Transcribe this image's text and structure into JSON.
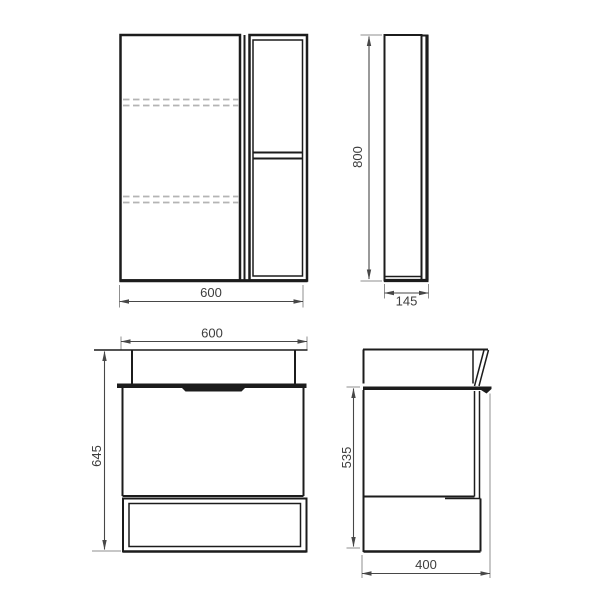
{
  "colors": {
    "object_line": "#1c1c1c",
    "dim_line": "#474747",
    "extension_line": "#8f8f8f",
    "hidden_line": "#b4b4b4",
    "text_color": "#3d3d3d"
  },
  "views": {
    "mirror_front": {
      "width_label": "600"
    },
    "mirror_side": {
      "height_label": "800",
      "depth_label": "145"
    },
    "vanity_front": {
      "width_label": "600",
      "height_label": "645"
    },
    "vanity_side": {
      "height_label": "535",
      "depth_label": "400"
    }
  }
}
